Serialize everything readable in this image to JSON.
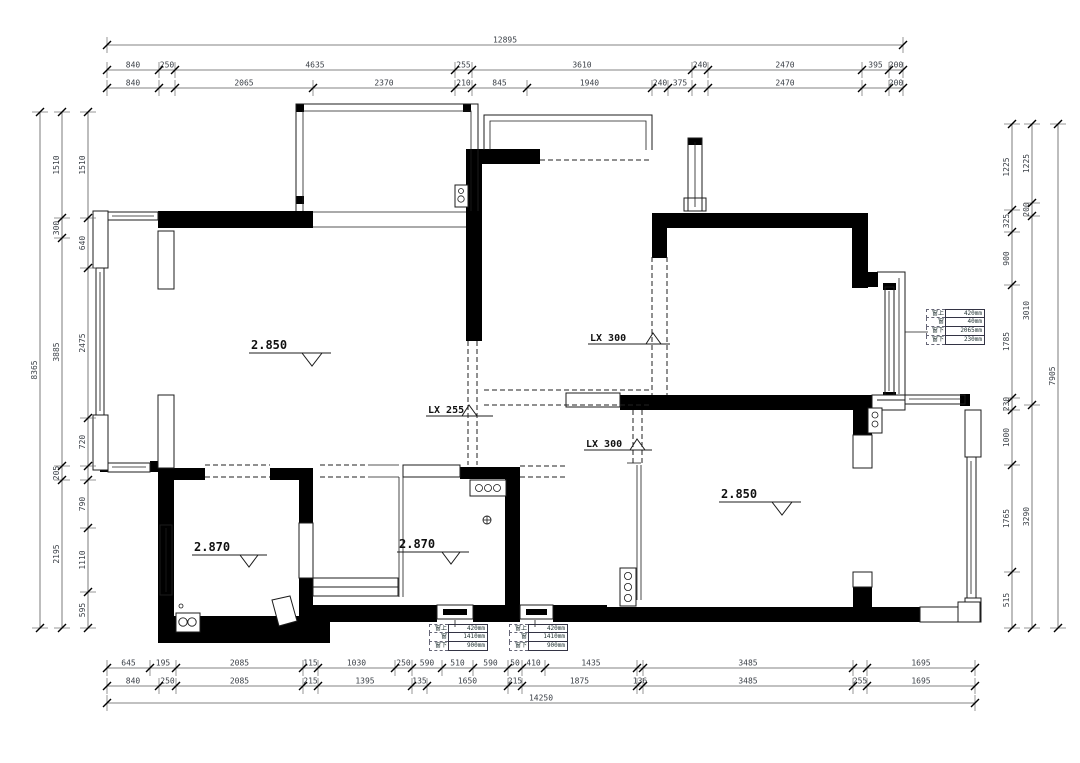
{
  "drawing_title": "residential floor plan",
  "rooms": {
    "living": {
      "elevation": "2.850"
    },
    "master": {
      "elevation": "2.850"
    },
    "bath_left": {
      "elevation": "2.870"
    },
    "bath_mid": {
      "elevation": "2.870"
    }
  },
  "lx_markers": {
    "top": {
      "label": "LX 300"
    },
    "middle": {
      "label": "LX 255"
    },
    "bottom": {
      "label": "LX 300"
    }
  },
  "window_tables": {
    "right": {
      "rows": [
        [
          "窗上",
          "420mm"
        ],
        [
          "窗",
          "40mm"
        ],
        [
          "窗下",
          "2065mm"
        ],
        [
          "窗下",
          "230mm"
        ]
      ]
    },
    "bottom_left": {
      "rows": [
        [
          "窗上",
          "420mm"
        ],
        [
          "窗",
          "1410mm"
        ],
        [
          "窗下",
          "900mm"
        ]
      ]
    },
    "bottom_right": {
      "rows": [
        [
          "窗上",
          "420mm"
        ],
        [
          "窗",
          "1410mm"
        ],
        [
          "窗下",
          "900mm"
        ]
      ]
    }
  },
  "dimensions": {
    "rows": [
      {
        "name": "top-overall",
        "axis": "x",
        "pos": 45,
        "segs": [
          [
            107,
            903,
            "12895"
          ]
        ]
      },
      {
        "name": "top-row2",
        "axis": "x",
        "pos": 70,
        "segs": [
          [
            107,
            159,
            "840"
          ],
          [
            159,
            175,
            "250"
          ],
          [
            175,
            455,
            "4635"
          ],
          [
            455,
            472,
            "255"
          ],
          [
            472,
            692,
            "3610"
          ],
          [
            692,
            708,
            "240"
          ],
          [
            708,
            862,
            "2470"
          ],
          [
            862,
            889,
            "395"
          ],
          [
            889,
            903,
            "200"
          ]
        ]
      },
      {
        "name": "top-row3",
        "axis": "x",
        "pos": 88,
        "segs": [
          [
            107,
            159,
            "840"
          ],
          [
            175,
            313,
            "2065"
          ],
          [
            313,
            455,
            "2370"
          ],
          [
            455,
            472,
            "210"
          ],
          [
            472,
            527,
            "845"
          ],
          [
            527,
            652,
            "1940"
          ],
          [
            652,
            668,
            "240"
          ],
          [
            668,
            692,
            "375"
          ],
          [
            708,
            862,
            "2470"
          ],
          [
            889,
            903,
            "200"
          ]
        ]
      },
      {
        "name": "bottom-row1",
        "axis": "x",
        "pos": 668,
        "segs": [
          [
            107,
            150,
            "645"
          ],
          [
            150,
            176,
            "195"
          ],
          [
            176,
            303,
            "2085"
          ],
          [
            303,
            318,
            "115"
          ],
          [
            318,
            395,
            "1030"
          ],
          [
            395,
            412,
            "250"
          ],
          [
            412,
            442,
            "590"
          ],
          [
            442,
            473,
            "510"
          ],
          [
            473,
            508,
            "590"
          ],
          [
            508,
            522,
            "50"
          ],
          [
            522,
            545,
            "410"
          ],
          [
            545,
            637,
            "1435"
          ],
          [
            643,
            853,
            "3485"
          ],
          [
            867,
            975,
            "1695"
          ]
        ]
      },
      {
        "name": "bottom-row2",
        "axis": "x",
        "pos": 686,
        "segs": [
          [
            107,
            159,
            "840"
          ],
          [
            159,
            176,
            "250"
          ],
          [
            176,
            303,
            "2085"
          ],
          [
            303,
            318,
            "215"
          ],
          [
            318,
            412,
            "1395"
          ],
          [
            412,
            427,
            "135"
          ],
          [
            427,
            508,
            "1650"
          ],
          [
            508,
            522,
            "215"
          ],
          [
            522,
            637,
            "1875"
          ],
          [
            637,
            643,
            "136"
          ],
          [
            643,
            853,
            "3485"
          ],
          [
            853,
            867,
            "255"
          ],
          [
            867,
            975,
            "1695"
          ]
        ]
      },
      {
        "name": "bottom-overall",
        "axis": "x",
        "pos": 703,
        "segs": [
          [
            107,
            975,
            "14250"
          ]
        ]
      },
      {
        "name": "left-overall",
        "axis": "y",
        "pos": 40,
        "segs": [
          [
            112,
            628,
            "8365"
          ]
        ]
      },
      {
        "name": "left-col2",
        "axis": "y",
        "pos": 62,
        "segs": [
          [
            112,
            218,
            "1510"
          ],
          [
            218,
            238,
            "300"
          ],
          [
            238,
            466,
            "3885"
          ],
          [
            466,
            480,
            "205"
          ],
          [
            480,
            628,
            "2195"
          ]
        ]
      },
      {
        "name": "left-col3",
        "axis": "y",
        "pos": 88,
        "segs": [
          [
            112,
            218,
            "1510"
          ],
          [
            218,
            268,
            "640"
          ],
          [
            268,
            418,
            "2475"
          ],
          [
            418,
            466,
            "720"
          ],
          [
            480,
            528,
            "790"
          ],
          [
            528,
            592,
            "1110"
          ],
          [
            592,
            628,
            "595"
          ]
        ]
      },
      {
        "name": "right-col1",
        "axis": "y",
        "pos": 1012,
        "segs": [
          [
            124,
            210,
            "1225"
          ],
          [
            210,
            232,
            "325"
          ],
          [
            232,
            285,
            "900"
          ],
          [
            285,
            398,
            "1785"
          ],
          [
            398,
            410,
            "230"
          ],
          [
            410,
            465,
            "1000"
          ],
          [
            465,
            572,
            "1765"
          ],
          [
            572,
            628,
            "515"
          ]
        ]
      },
      {
        "name": "right-col2",
        "axis": "y",
        "pos": 1032,
        "segs": [
          [
            124,
            203,
            "1225"
          ],
          [
            203,
            216,
            "200"
          ],
          [
            216,
            405,
            "3010"
          ],
          [
            405,
            628,
            "3290"
          ]
        ]
      },
      {
        "name": "right-overall",
        "axis": "y",
        "pos": 1058,
        "segs": [
          [
            124,
            628,
            "7905"
          ]
        ]
      }
    ]
  }
}
